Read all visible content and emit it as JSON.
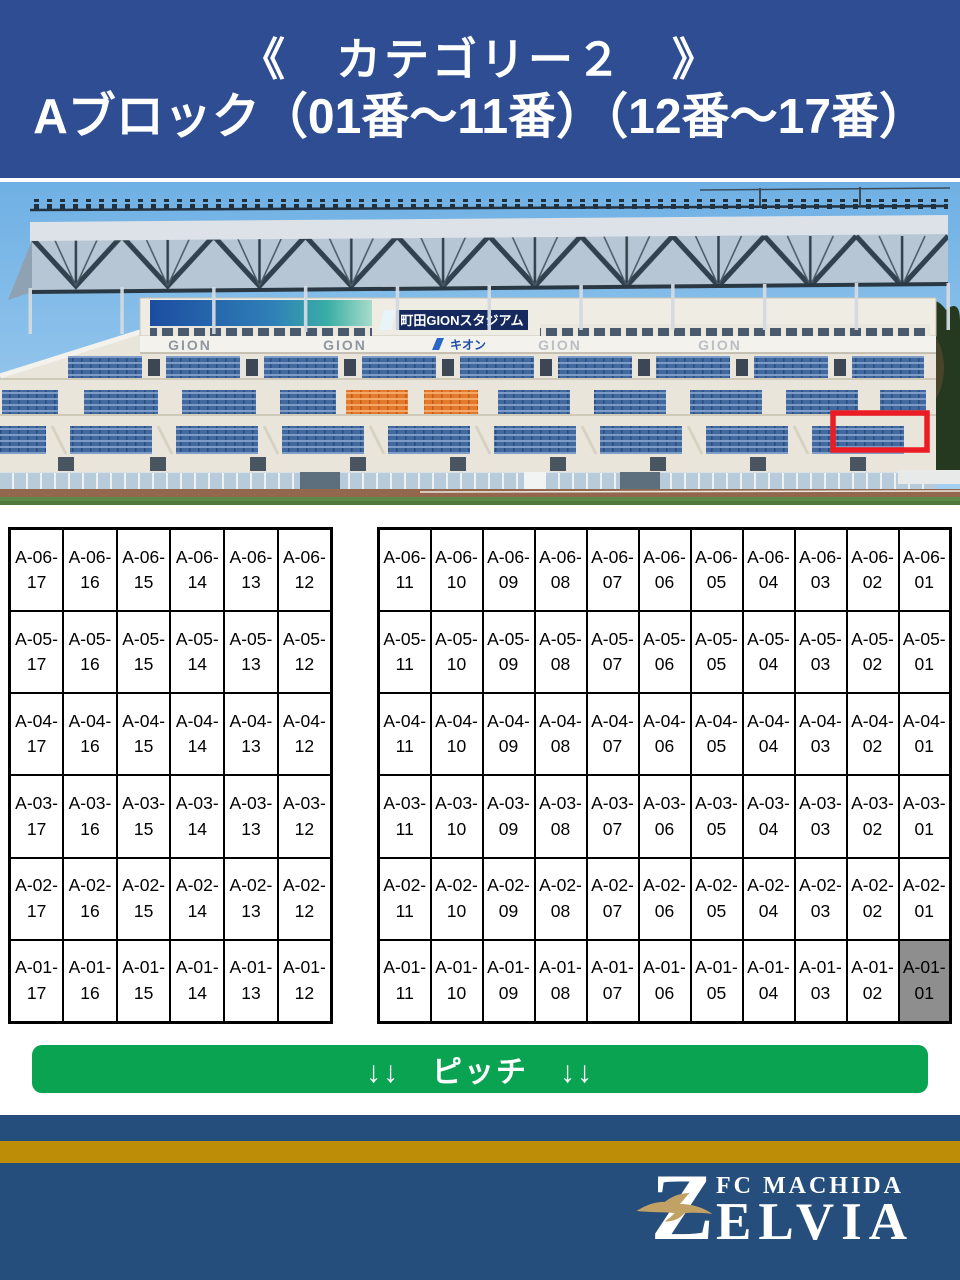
{
  "header": {
    "title": "《　カテゴリー２　》",
    "subtitle": "Aブロック（01番～11番）（12番～17番）"
  },
  "photo": {
    "stadium_sign": "町田GIONスタジアム",
    "gion_sign": "GION",
    "kion_sign": "キオン"
  },
  "seat_map": {
    "row_prefix": "A",
    "rows": [
      "06",
      "05",
      "04",
      "03",
      "02",
      "01"
    ],
    "left_block_seats": [
      "17",
      "16",
      "15",
      "14",
      "13",
      "12"
    ],
    "right_block_seats": [
      "11",
      "10",
      "09",
      "08",
      "07",
      "06",
      "05",
      "04",
      "03",
      "02",
      "01"
    ],
    "highlighted_seat": "A-01-01"
  },
  "pitch_banner": {
    "label": "↓↓　ピッチ　↓↓"
  },
  "footer": {
    "club_initial": "Z",
    "club_line1": "FC MACHIDA",
    "club_line2": "ELVIA"
  },
  "colors": {
    "header_bg": "#2e4d92",
    "banner_green": "#0aa351",
    "footer_blue": "#254e7c",
    "footer_gold": "#bd8d07",
    "highlight_gray": "#8e8e8e",
    "highlight_red": "#ec1c24",
    "logo_gold": "#c2a264"
  }
}
